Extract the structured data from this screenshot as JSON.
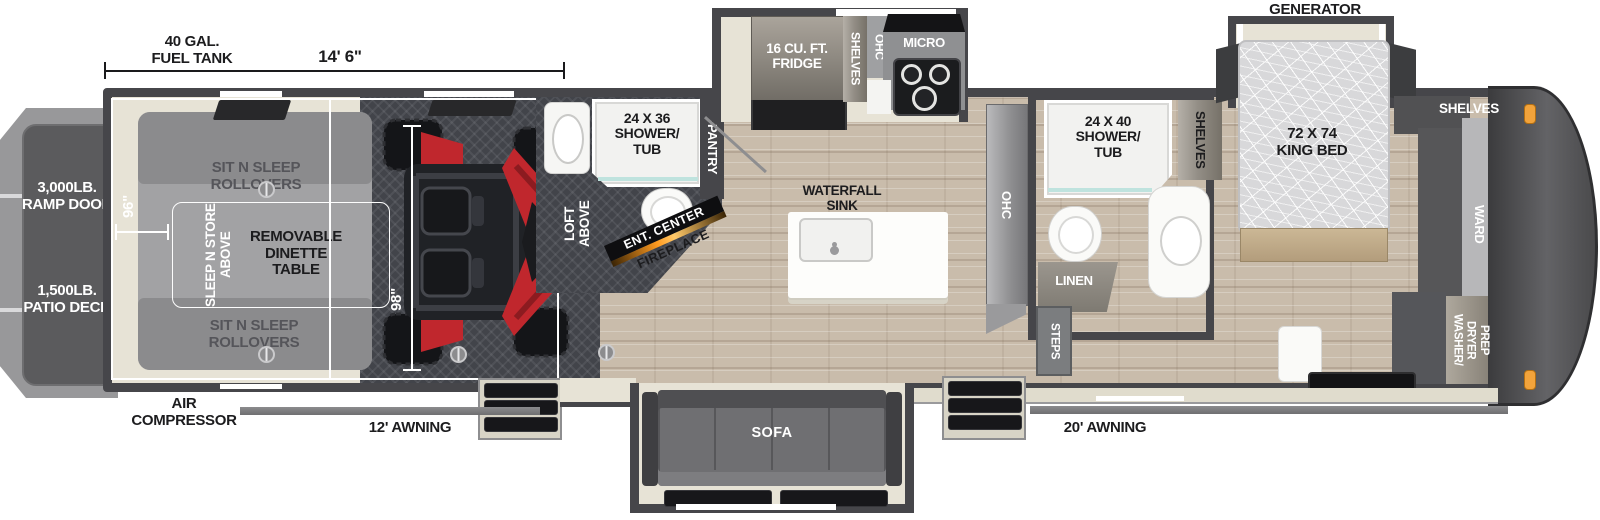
{
  "dims": {
    "fuel_tank": "40 GAL.\nFUEL TANK",
    "length": "14' 6\"",
    "garage_width": "96\"",
    "garage_interior": "98\""
  },
  "exterior": {
    "ramp_door": "3,000LB.\nRAMP DOOR",
    "patio_deck": "1,500LB.\nPATIO DECK",
    "air_compressor": "AIR\nCOMPRESSOR",
    "awning_garage": "12' AWNING",
    "awning_main": "20' AWNING",
    "generator_prep": "GENERATOR\nPREP"
  },
  "garage": {
    "rollovers_top": "SIT N SLEEP\nROLLOVERS",
    "rollovers_bottom": "SIT N SLEEP\nROLLOVERS",
    "dinette_table": "REMOVABLE\nDINETTE\nTABLE",
    "sleep_n_store": "SLEEP N STORE\nABOVE",
    "loft": "LOFT\nABOVE"
  },
  "mid_bath": {
    "shower_tub": "24 X 36\nSHOWER/\nTUB",
    "pantry": "PANTRY",
    "ent_center": "ENT. CENTER",
    "fireplace": "FIREPLACE"
  },
  "kitchen": {
    "fridge": "16 CU. FT.\nFRIDGE",
    "shelves": "SHELVES",
    "ohc": "OHC",
    "micro": "MICRO",
    "waterfall_sink": "WATERFALL\nSINK",
    "ohc_cabinet": "OHC"
  },
  "main_bath": {
    "shower_tub": "24 X 40\nSHOWER/\nTUB",
    "shelves": "SHELVES",
    "linen": "LINEN",
    "steps": "STEPS"
  },
  "bedroom": {
    "king_bed": "72 X 74\nKING BED",
    "shelves": "SHELVES",
    "ward": "WARD",
    "washer_dryer": "WASHER/\nDRYER\nPREP"
  },
  "living": {
    "sofa": "SOFA"
  },
  "colors": {
    "wall": "#46464a",
    "marker_light": "#f2a33b",
    "fireplace_glow": "#ff9a1f",
    "atv_red": "#c0272d"
  }
}
